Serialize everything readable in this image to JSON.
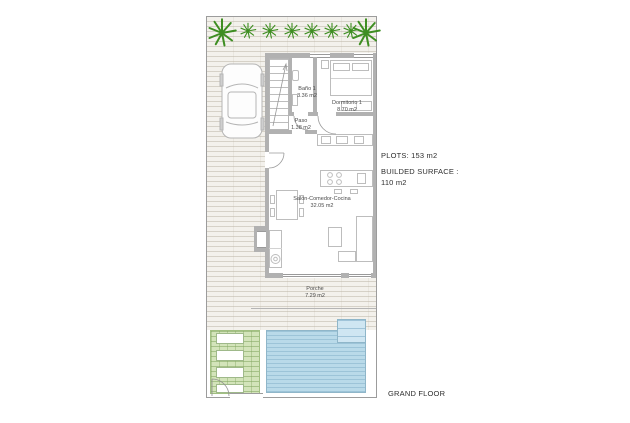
{
  "plan": {
    "plots_label": "PLOTS: 153 m2",
    "built_surface_label": "BUILDED SURFACE :",
    "built_surface_value": "110 m2",
    "floor_label": "GRAND FLOOR"
  },
  "rooms": [
    {
      "name": "Baño 1",
      "area": "3.36 m2"
    },
    {
      "name": "Dormitorio 1",
      "area": "8.70 m2"
    },
    {
      "name": "Paso",
      "area": "1.38 m2"
    },
    {
      "name": "Salón-Comedor-Cocina",
      "area": "32.05 m2"
    },
    {
      "name": "Porche",
      "area": "7.29 m2"
    }
  ],
  "colors": {
    "palm_green": "#3e8e22",
    "pool_blue": "#b9dae9",
    "deck_green": "#d3e4ba",
    "wall_gray": "#b1b1b1",
    "paving_stripe": "#bab2a3",
    "text": "#2e2e2e"
  },
  "icons": {
    "palm_tree_icon": "green radiating frond star",
    "car_icon": "top-view car outline",
    "stairs_icon": "treads with direction arrow",
    "door_arc_icon": "quarter-circle door swing",
    "washer_icon": "circle appliance in cabinet",
    "cooktop_icon": "four burner circles"
  }
}
